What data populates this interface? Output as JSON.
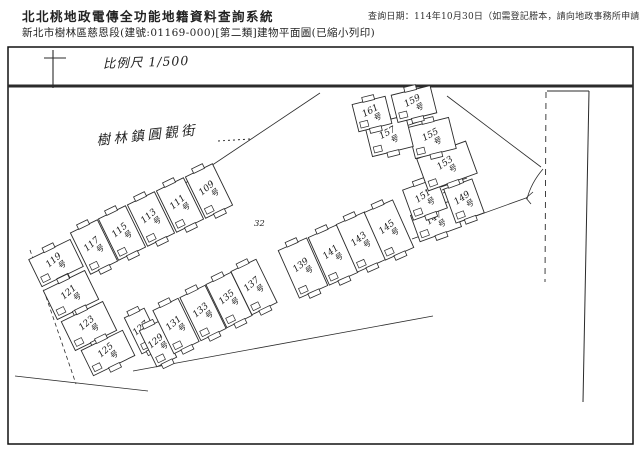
{
  "header": {
    "title": "北北桃地政電傳全功能地籍資料查詢系統",
    "query_date": "查詢日期：114年10月30日（如需登記謄本，請向地政事務所申請。）",
    "subtitle": "新北市樹林區慈恩段(建號:01169-000)[第二類]建物平面圖(已縮小列印)"
  },
  "plan": {
    "scale_label": "比例尺 1/500",
    "street_label": "樹林鎮圓觀街",
    "parcel_label": "32",
    "unit_suffix": "号",
    "line_color": "#2b2b2b",
    "units": [
      {
        "no": "109",
        "cx": 209,
        "cy": 191,
        "w": 30,
        "h": 46,
        "rot": -26
      },
      {
        "no": "111",
        "cx": 180,
        "cy": 205,
        "w": 30,
        "h": 46,
        "rot": -26
      },
      {
        "no": "113",
        "cx": 151,
        "cy": 219,
        "w": 30,
        "h": 46,
        "rot": -26
      },
      {
        "no": "115",
        "cx": 122,
        "cy": 233,
        "w": 30,
        "h": 46,
        "rot": -26
      },
      {
        "no": "117",
        "cx": 94,
        "cy": 247,
        "w": 30,
        "h": 46,
        "rot": -26
      },
      {
        "no": "119",
        "cx": 56,
        "cy": 263,
        "w": 46,
        "h": 30,
        "rot": -26
      },
      {
        "no": "121",
        "cx": 71,
        "cy": 295,
        "w": 46,
        "h": 32,
        "rot": -26
      },
      {
        "no": "123",
        "cx": 89,
        "cy": 326,
        "w": 46,
        "h": 32,
        "rot": -26
      },
      {
        "no": "125",
        "cx": 108,
        "cy": 353,
        "w": 46,
        "h": 28,
        "rot": -26
      },
      {
        "no": "127",
        "cx": 143,
        "cy": 331,
        "w": 22,
        "h": 40,
        "rot": -26
      },
      {
        "no": "129",
        "cx": 158,
        "cy": 344,
        "w": 22,
        "h": 40,
        "rot": -26
      },
      {
        "no": "131",
        "cx": 176,
        "cy": 326,
        "w": 28,
        "h": 48,
        "rot": -26
      },
      {
        "no": "133",
        "cx": 203,
        "cy": 313,
        "w": 28,
        "h": 48,
        "rot": -26
      },
      {
        "no": "135",
        "cx": 229,
        "cy": 300,
        "w": 28,
        "h": 48,
        "rot": -26
      },
      {
        "no": "137",
        "cx": 254,
        "cy": 287,
        "w": 28,
        "h": 48,
        "rot": -26
      },
      {
        "no": "139",
        "cx": 303,
        "cy": 268,
        "w": 31,
        "h": 52,
        "rot": -24
      },
      {
        "no": "141",
        "cx": 333,
        "cy": 255,
        "w": 31,
        "h": 52,
        "rot": -24
      },
      {
        "no": "143",
        "cx": 361,
        "cy": 242,
        "w": 31,
        "h": 52,
        "rot": -24
      },
      {
        "no": "145",
        "cx": 389,
        "cy": 230,
        "w": 31,
        "h": 52,
        "rot": -24
      },
      {
        "no": "147",
        "cx": 436,
        "cy": 221,
        "w": 44,
        "h": 28,
        "rot": -20
      },
      {
        "no": "149",
        "cx": 464,
        "cy": 201,
        "w": 30,
        "h": 36,
        "rot": -20
      },
      {
        "no": "151",
        "cx": 425,
        "cy": 199,
        "w": 36,
        "h": 32,
        "rot": -20
      },
      {
        "no": "153",
        "cx": 447,
        "cy": 166,
        "w": 52,
        "h": 34,
        "rot": -20
      },
      {
        "no": "155",
        "cx": 432,
        "cy": 138,
        "w": 42,
        "h": 32,
        "rot": -14
      },
      {
        "no": "157",
        "cx": 389,
        "cy": 136,
        "w": 42,
        "h": 32,
        "rot": -14
      },
      {
        "no": "159",
        "cx": 414,
        "cy": 104,
        "w": 40,
        "h": 28,
        "rot": -14
      },
      {
        "no": "161",
        "cx": 372,
        "cy": 114,
        "w": 34,
        "h": 28,
        "rot": -14
      }
    ],
    "boundaries": [
      {
        "x1": 8,
        "y1": 86,
        "x2": 633,
        "y2": 86,
        "w": 3
      },
      {
        "x1": 53,
        "y1": 50,
        "x2": 53,
        "y2": 88,
        "w": 1.1
      },
      {
        "x1": 44,
        "y1": 58,
        "x2": 66,
        "y2": 58,
        "w": 1.1
      },
      {
        "x1": 547,
        "y1": 91,
        "x2": 589,
        "y2": 91,
        "w": 1
      },
      {
        "x1": 589,
        "y1": 91,
        "x2": 583,
        "y2": 402,
        "w": 1
      },
      {
        "x1": 546,
        "y1": 92,
        "x2": 545,
        "y2": 282,
        "w": 0.9,
        "dash": "6 5"
      },
      {
        "x1": 447,
        "y1": 96,
        "x2": 541,
        "y2": 167,
        "w": 0.8
      },
      {
        "x1": 412,
        "y1": 239,
        "x2": 526,
        "y2": 198,
        "w": 0.8
      },
      {
        "x1": 526,
        "y1": 198,
        "x2": 533,
        "y2": 192,
        "w": 0.8
      },
      {
        "x1": 526,
        "y1": 198,
        "x2": 531,
        "y2": 204,
        "w": 0.8
      },
      {
        "x1": 320,
        "y1": 93,
        "x2": 172,
        "y2": 192,
        "w": 0.8
      },
      {
        "x1": 15,
        "y1": 376,
        "x2": 148,
        "y2": 391,
        "w": 0.8
      },
      {
        "x1": 133,
        "y1": 371,
        "x2": 433,
        "y2": 316,
        "w": 0.8
      },
      {
        "x1": 30,
        "y1": 250,
        "x2": 76,
        "y2": 384,
        "w": 0.8,
        "dash": "4 3"
      },
      {
        "x1": 218,
        "y1": 141,
        "x2": 250,
        "y2": 139,
        "w": 1,
        "dash": "2 3"
      },
      {
        "x1": 441,
        "y1": 187,
        "x2": 467,
        "y2": 178,
        "w": 0.8
      },
      {
        "x1": 442,
        "y1": 190,
        "x2": 468,
        "y2": 181,
        "w": 0.8
      },
      {
        "x1": 443,
        "y1": 193,
        "x2": 469,
        "y2": 184,
        "w": 0.8
      },
      {
        "x1": 406,
        "y1": 126,
        "x2": 430,
        "y2": 118,
        "w": 0.8
      },
      {
        "x1": 407,
        "y1": 129,
        "x2": 431,
        "y2": 121,
        "w": 0.8
      },
      {
        "x1": 408,
        "y1": 132,
        "x2": 432,
        "y2": 124,
        "w": 0.8
      }
    ],
    "paths": [
      {
        "d": "M 543 169 Q 531 183 527 199",
        "w": 0.8
      }
    ]
  }
}
